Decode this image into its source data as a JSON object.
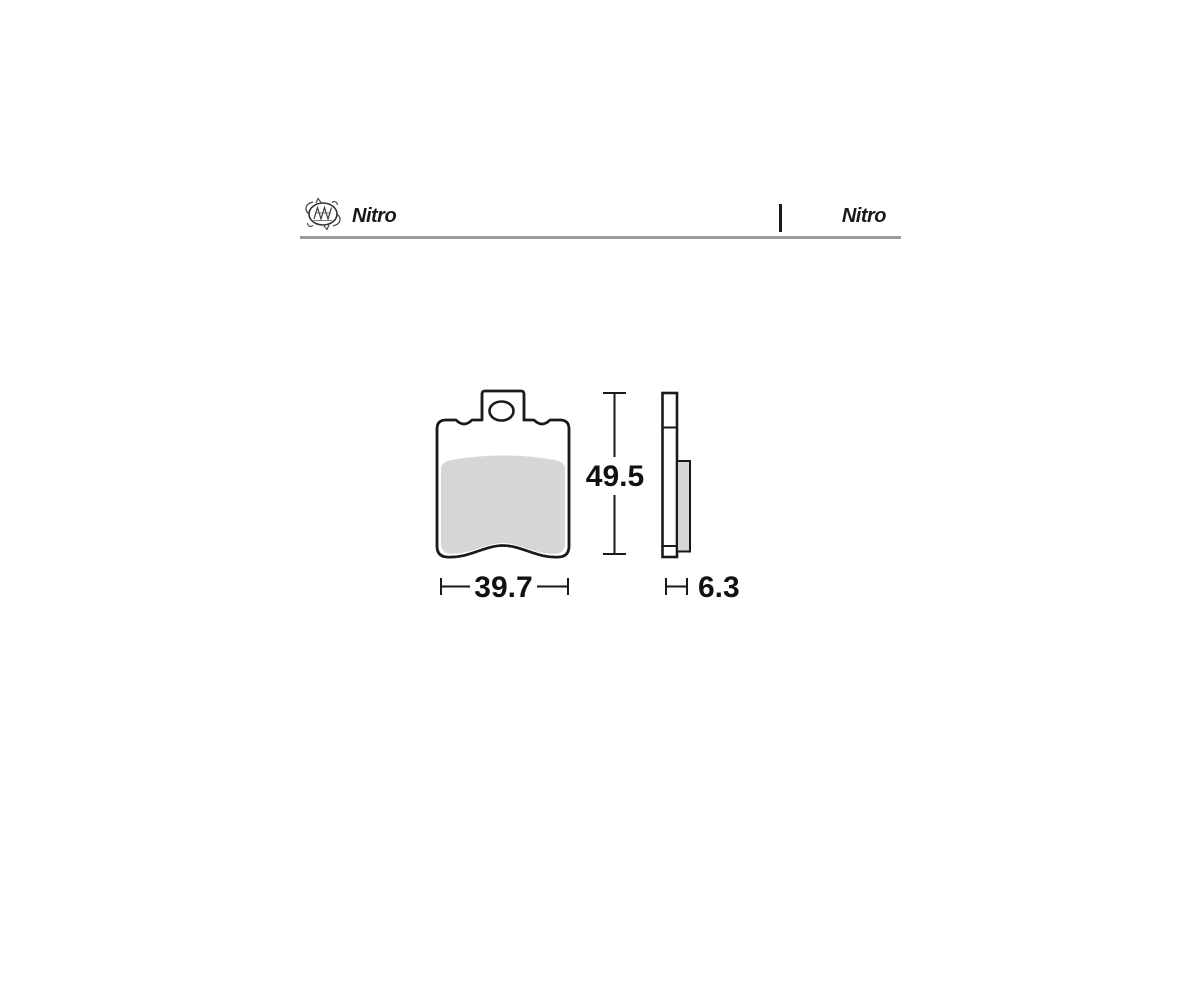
{
  "header": {
    "brand_left": "Nitro",
    "brand_right": "Nitro",
    "logo": "moto-master-swirl-badge"
  },
  "diagram": {
    "subject": "brake pad dimensional drawing",
    "front_view": {
      "width_mm": "39.7",
      "height_mm": "49.5"
    },
    "side_view": {
      "thickness_mm": "6.3"
    },
    "colors": {
      "outline": "#1a1a1a",
      "friction_material": "#d6d6d6",
      "header_rule": "#9a9a9a"
    }
  }
}
